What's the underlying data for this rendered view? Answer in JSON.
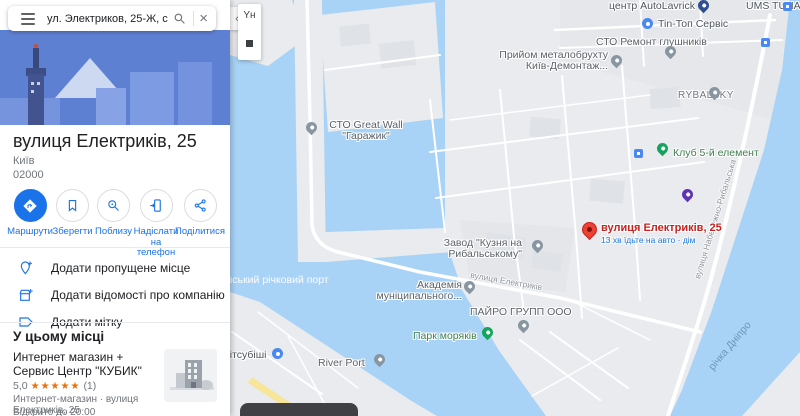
{
  "search": {
    "query": "ул. Электриков, 25-Ж, с 2012",
    "close_glyph": "×"
  },
  "panel_toggle_glyph": "‹",
  "place": {
    "title": "вулиця Електриків, 25",
    "city": "Київ",
    "postal_code": "02000"
  },
  "actions": {
    "directions": "Маршрути",
    "save": "Зберегти",
    "nearby": "Поблизу",
    "send": "Надіслати на телефон",
    "share": "Поділитися"
  },
  "menu": {
    "add_place": "Додати пропущене місце",
    "add_business": "Додати відомості про компанію",
    "add_label": "Додати мітку"
  },
  "section_title": "У цьому місці",
  "listing": {
    "name": "Интернет магазин + Сервис Центр \"КУБИК\"",
    "rating": "5,0",
    "stars": "★★★★★",
    "review_count": "(1)",
    "category_address": "Интернет-магазин · вулиця Електриків, 25",
    "hours": "Відкрито до 20:00"
  },
  "map": {
    "control_label": "Yн",
    "marker": {
      "title": "вулиця Електриків, 25",
      "eta": "13 хв їдьте на авто · дім"
    },
    "pois": {
      "autolavrick": "центр AutoLavrick",
      "ums_tuna": "UMS TUNA",
      "tin_top": "Tin-Топ Сервіс",
      "sto_remont": "СТО Ремонт глушників",
      "metal1": "Прийом металобрухту",
      "metal2": "Київ-Демонтаж...",
      "rybalsky": "RYBALSKY",
      "club": "Клуб 5-й елемент",
      "greatwall1": "СТО Great Wall",
      "greatwall2": "\"Гаражик\"",
      "zavod1": "Завод \"Кузня на",
      "zavod2": "Рибальському\"",
      "akademia1": "Академія",
      "akademia2": "муніципального...",
      "pairo": "ПАЙРО ГРУПП ООО",
      "park": "Парк моряків",
      "river_port": "River Port",
      "mitsubishi": "Мітсубіші"
    },
    "streets": {
      "elektrykiv": "вулиця Електриків",
      "naberezhna": "вулиця Набережно-Рибальська"
    },
    "water_labels": {
      "dnipro": "річка Дніпро",
      "port": "Київський річковий порт"
    }
  },
  "colors": {
    "accent": "#1a73e8",
    "marker_red": "#ea4335",
    "water": "#a9d3f6",
    "stars": "#e8710a"
  }
}
